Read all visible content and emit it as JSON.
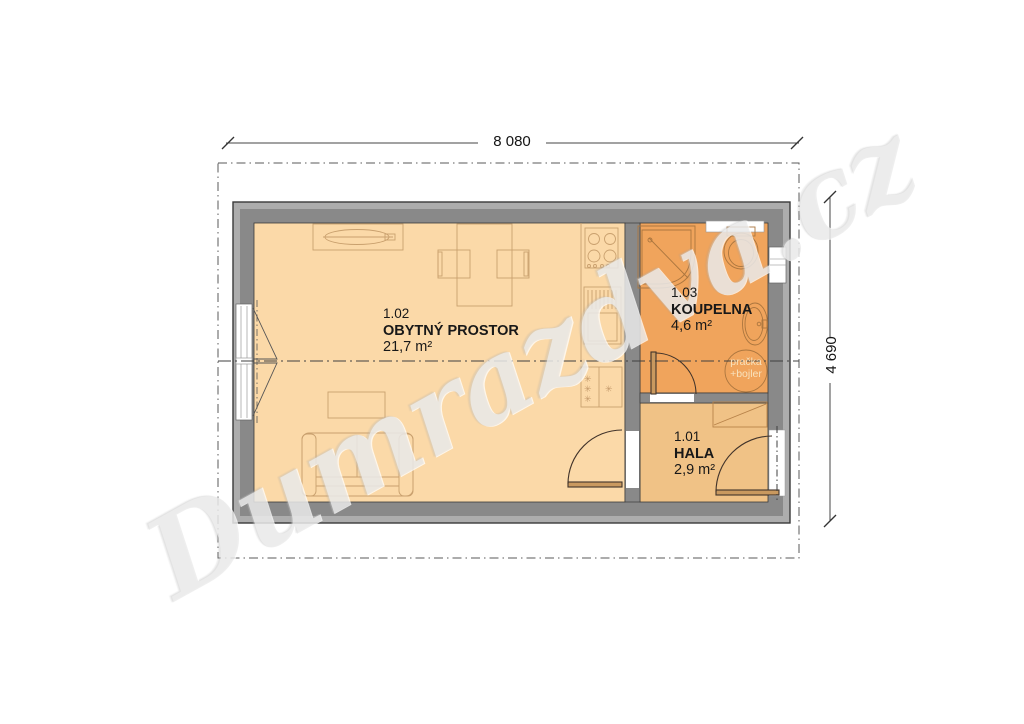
{
  "watermark": {
    "text": "Dumrazdva.cz"
  },
  "dimensions": {
    "width_label": "8 080",
    "height_label": "4 690"
  },
  "rooms": [
    {
      "number": "1.02",
      "name": "OBYTNÝ PROSTOR",
      "area": "21,7 m²"
    },
    {
      "number": "1.03",
      "name": "KOUPELNA",
      "area": "4,6 m²"
    },
    {
      "number": "1.01",
      "name": "HALA",
      "area": "2,9 m²"
    }
  ],
  "appliances": {
    "washer_boiler_line1": "pračka",
    "washer_boiler_line2": "+bojler"
  },
  "symbols": {
    "freezer_star": "✳"
  },
  "colors": {
    "wall_inner": "#898989",
    "wall_outer": "#adadad",
    "living_fill": "#fbd9a8",
    "hall_fill": "#f0c286",
    "bathroom_fill": "#f0a45c",
    "furniture_stroke": "#c9a06e",
    "fixture_stroke": "#ab763f",
    "door_stroke": "#41332a"
  }
}
